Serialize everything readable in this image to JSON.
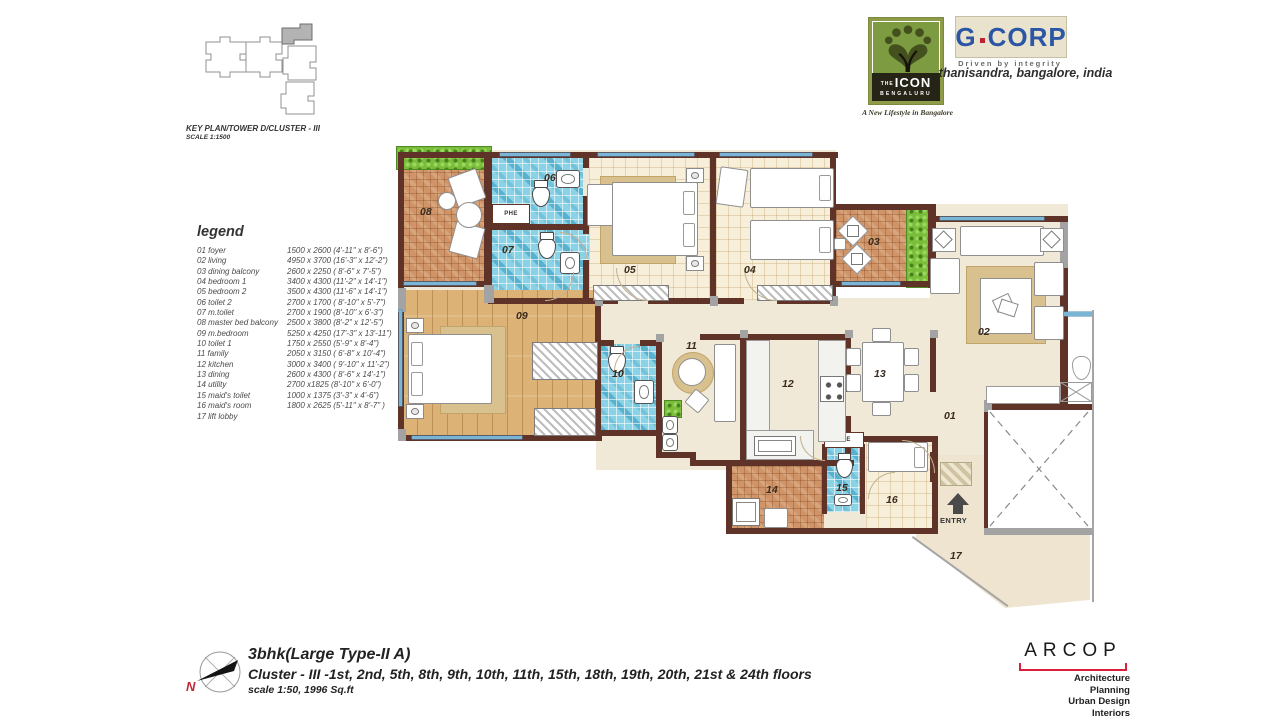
{
  "key_plan": {
    "line1": "KEY PLAN/TOWER D/CLUSTER - III",
    "line2": "SCALE 1:1500"
  },
  "brand": {
    "icon_logo": {
      "the": "THE",
      "name": "ICON",
      "city": "BENGALURU",
      "tagline": "A New Lifestyle in Bangalore"
    },
    "gcorp": {
      "g": "G",
      "rest": "CORP",
      "tagline": "Driven by integrity",
      "location": "thanisandra, bangalore, india"
    },
    "arcop": {
      "name": "ARCOP",
      "s1": "Architecture",
      "s2": "Planning",
      "s3": "Urban Design",
      "s4": "Interiors"
    }
  },
  "legend": {
    "title": "legend",
    "items": [
      {
        "name": "01 foyer",
        "dims": "1500 x 2600 (4'-11\" x 8'-6\")"
      },
      {
        "name": "02 living",
        "dims": "4950 x 3700 (16'-3\" x 12'-2\")"
      },
      {
        "name": "03 dining balcony",
        "dims": "2600 x 2250 ( 8'-6\" x 7'-5\")"
      },
      {
        "name": "04 bedroom 1",
        "dims": "3400 x 4300 (11'-2\" x 14'-1\")"
      },
      {
        "name": "05 bedroom 2",
        "dims": "3500 x 4300 (11'-6\" x 14'-1\")"
      },
      {
        "name": "06 toilet 2",
        "dims": "2700 x 1700 ( 8'-10\" x 5'-7\")"
      },
      {
        "name": "07 m.toilet",
        "dims": "2700 x 1900 (8'-10\" x 6'-3\")"
      },
      {
        "name": "08 master bed balcony",
        "dims": "2500 x 3800 (8'-2\" x 12'-5\")"
      },
      {
        "name": "09 m.bedroom",
        "dims": "5250 x 4250 (17'-3\" x 13'-11\")"
      },
      {
        "name": "10 toilet 1",
        "dims": "1750  x 2550 (5'-9\" x 8'-4\")"
      },
      {
        "name": "11 family",
        "dims": "2050 x 3150  ( 6'-8\" x 10'-4\")"
      },
      {
        "name": "12 kitchen",
        "dims": "3000 x 3400  ( 9'-10\" x 11'-2\")"
      },
      {
        "name": "13 dining",
        "dims": "2600 x 4300  ( 8'-6\" x 14'-1\")"
      },
      {
        "name": "14 utility",
        "dims": "2700 x1825  (8'-10\" x 6'-0\")"
      },
      {
        "name": "15 maid's toilet",
        "dims": "1000 x 1375 (3'-3\" x 4'-6\")"
      },
      {
        "name": "16 maid's room",
        "dims": "1800 x 2625 (5'-11\" x 8'-7\" )"
      },
      {
        "name": "17 lift lobby",
        "dims": ""
      }
    ]
  },
  "plan": {
    "labels": {
      "r01": "01",
      "r02": "02",
      "r03": "03",
      "r04": "04",
      "r05": "05",
      "r06": "06",
      "r07": "07",
      "r08": "08",
      "r09": "09",
      "r10": "10",
      "r11": "11",
      "r12": "12",
      "r13": "13",
      "r14": "14",
      "r15": "15",
      "r16": "16",
      "r17": "17"
    },
    "entry": "ENTRY",
    "phe_a": "PHE",
    "phe_b": "PHE"
  },
  "footer": {
    "north": "N",
    "title": "3bhk(Large Type-II A)",
    "subtitle": "Cluster - III -1st, 2nd, 5th, 8th, 9th, 10th, 11th, 15th, 18th, 19th, 20th, 21st & 24th floors",
    "scale_note": "scale 1:50, 1996 Sq.ft"
  },
  "colors": {
    "wall": "#5f3327",
    "terracotta": "#cf9468",
    "mosaic_blue": "#8ad2e6",
    "wood": "#dcb277",
    "bedroom_tile": "#f7efd9",
    "floor_cream": "#f1e9d7",
    "planter_green": "#79bd3b",
    "window_glass": "#7ab5d6",
    "brand_green": "#7d9c42",
    "brand_blue": "#2b56a5",
    "accent_red": "#d9203b"
  }
}
